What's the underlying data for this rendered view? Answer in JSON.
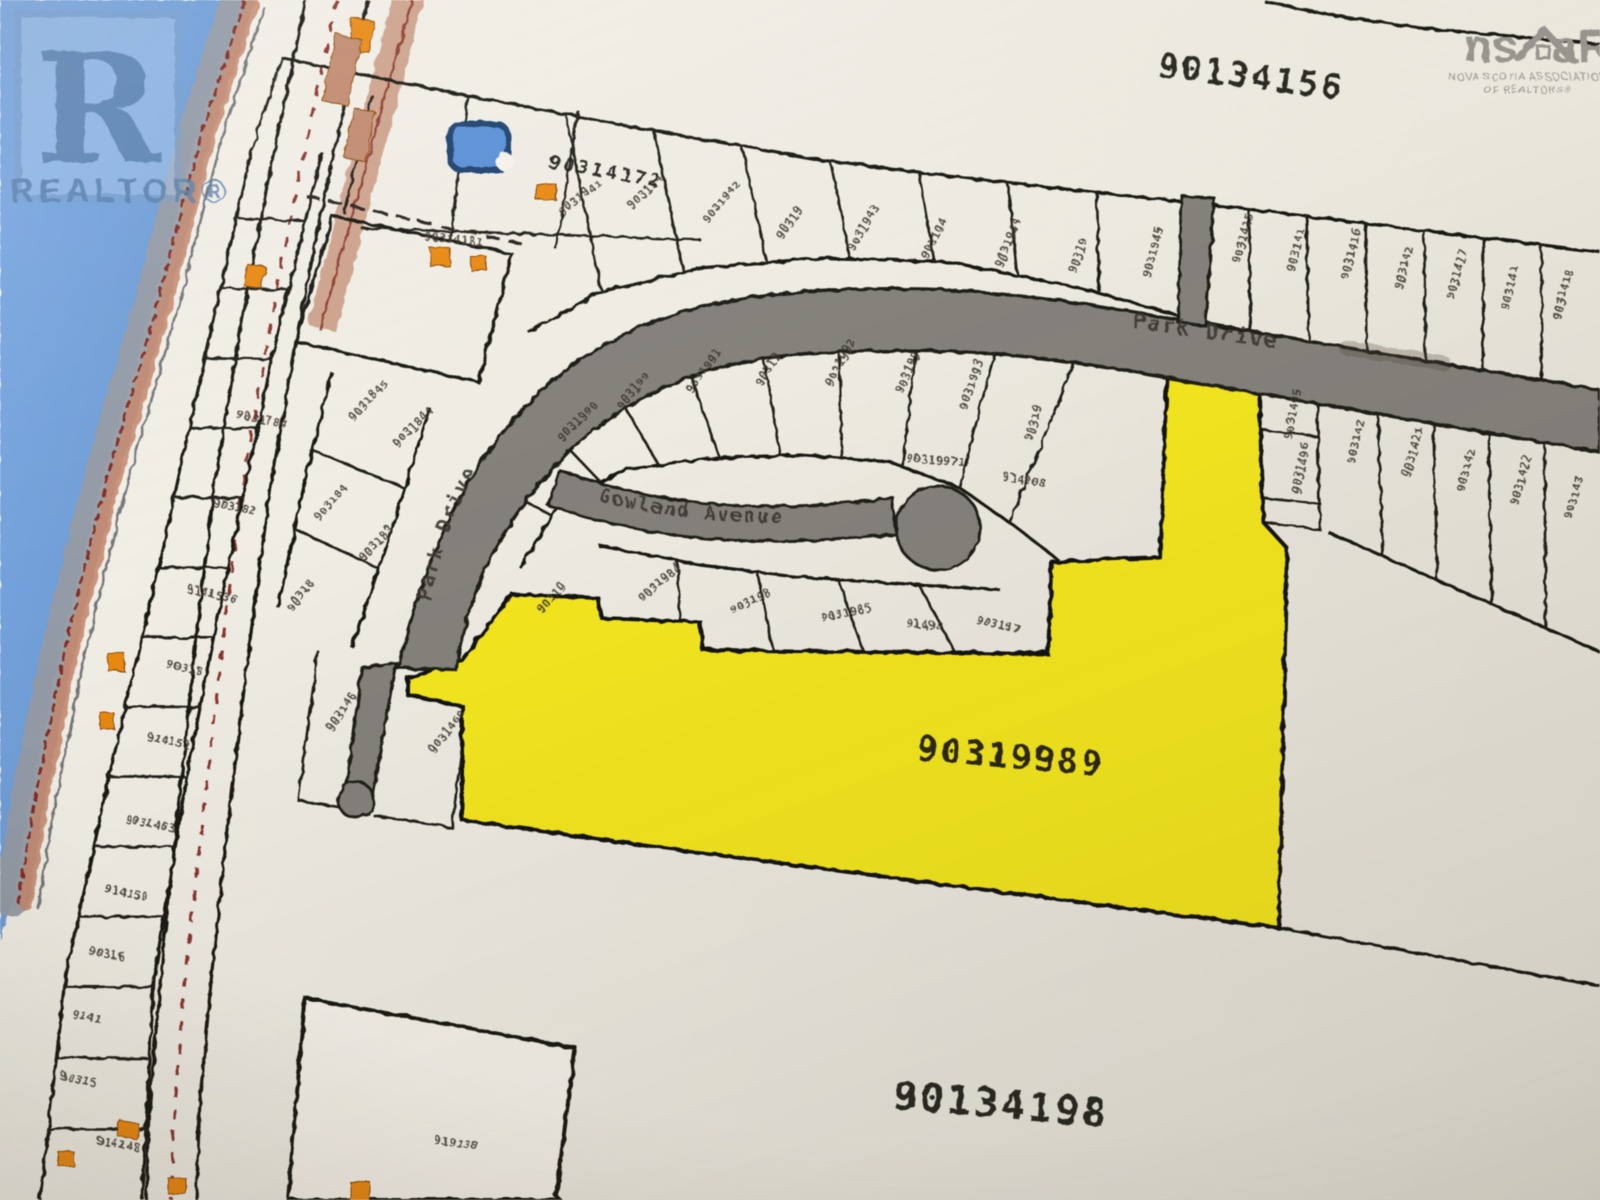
{
  "branding": {
    "realtor": {
      "letter": "R",
      "label": "REALTOR®"
    },
    "nsar": {
      "left": "ns",
      "right": "aR",
      "line1": "NOVA SCOTIA ASSOCIATION",
      "line2": "OF REALTORS®"
    }
  },
  "map": {
    "parcels": {
      "top_right": "90134156",
      "highlighted": "90319989",
      "bottom": "90134198",
      "pond_lot": "90314172"
    },
    "streets": {
      "park_drive_right": "Park Drive",
      "park_drive_curve": "Park Drive",
      "gowland_avenue": "Gowland Avenue"
    },
    "colors": {
      "highlight": "#efe32b",
      "water": "#6f9bd3",
      "road": "#85827b",
      "building": "#e2891d",
      "paper": "#f2efe7"
    },
    "micro_labels": [
      [
        "9031784",
        236,
        418,
        12
      ],
      [
        "903182",
        212,
        506,
        12
      ],
      [
        "9141536",
        186,
        592,
        13
      ],
      [
        "90318",
        166,
        668,
        12
      ],
      [
        "914152",
        146,
        740,
        12
      ],
      [
        "9031463",
        124,
        822,
        12
      ],
      [
        "914150",
        104,
        892,
        12
      ],
      [
        "90316",
        88,
        954,
        11
      ],
      [
        "9141",
        72,
        1018,
        11
      ],
      [
        "90315",
        60,
        1080,
        11
      ],
      [
        "914148",
        96,
        1144,
        10
      ],
      [
        "90314181",
        424,
        240,
        6
      ],
      [
        "9031845",
        354,
        422,
        -48
      ],
      [
        "903184",
        320,
        522,
        -50
      ],
      [
        "90318",
        292,
        612,
        -52
      ],
      [
        "9031844",
        398,
        448,
        -46
      ],
      [
        "903183",
        364,
        562,
        -48
      ],
      [
        "903146",
        332,
        732,
        -55
      ],
      [
        "9031460",
        434,
        754,
        -52
      ],
      [
        "9031941",
        562,
        216,
        -38
      ],
      [
        "903194",
        632,
        210,
        -44
      ],
      [
        "9031942",
        708,
        224,
        -50
      ],
      [
        "90319",
        782,
        240,
        -55
      ],
      [
        "9031943",
        854,
        252,
        -60
      ],
      [
        "903194",
        928,
        260,
        -64
      ],
      [
        "9031944",
        1002,
        268,
        -68
      ],
      [
        "90319",
        1076,
        274,
        -72
      ],
      [
        "9031945",
        1150,
        278,
        -75
      ],
      [
        "9031415",
        1240,
        264,
        -75
      ],
      [
        "903141",
        1294,
        272,
        -75
      ],
      [
        "9031416",
        1348,
        280,
        -75
      ],
      [
        "903142",
        1402,
        290,
        -75
      ],
      [
        "9031417",
        1454,
        300,
        -75
      ],
      [
        "903141",
        1508,
        310,
        -75
      ],
      [
        "9031418",
        1560,
        320,
        -75
      ],
      [
        "903142",
        1354,
        464,
        -75
      ],
      [
        "9031421",
        1410,
        478,
        -75
      ],
      [
        "903142",
        1464,
        492,
        -75
      ],
      [
        "9031422",
        1518,
        506,
        -75
      ],
      [
        "903143",
        1572,
        520,
        -75
      ],
      [
        "9031495",
        1292,
        440,
        -80
      ],
      [
        "9031496",
        1300,
        494,
        -80
      ],
      [
        "9031990",
        562,
        442,
        -45
      ],
      [
        "903199",
        622,
        410,
        -50
      ],
      [
        "9031991",
        692,
        394,
        -55
      ],
      [
        "90319",
        762,
        387,
        -60
      ],
      [
        "9031992",
        832,
        387,
        -63
      ],
      [
        "903199",
        902,
        394,
        -66
      ],
      [
        "9031993",
        966,
        410,
        -70
      ],
      [
        "90319",
        1032,
        442,
        -73
      ],
      [
        "90319971",
        906,
        462,
        4
      ],
      [
        "914908",
        1002,
        480,
        10
      ],
      [
        "9031984",
        642,
        602,
        -40
      ],
      [
        "903198",
        732,
        614,
        -25
      ],
      [
        "9031985",
        822,
        622,
        -12
      ],
      [
        "91498",
        906,
        627,
        5
      ],
      [
        "903197",
        976,
        624,
        12
      ],
      [
        "90319",
        542,
        614,
        -48
      ],
      [
        "919138",
        434,
        1144,
        8
      ]
    ]
  }
}
